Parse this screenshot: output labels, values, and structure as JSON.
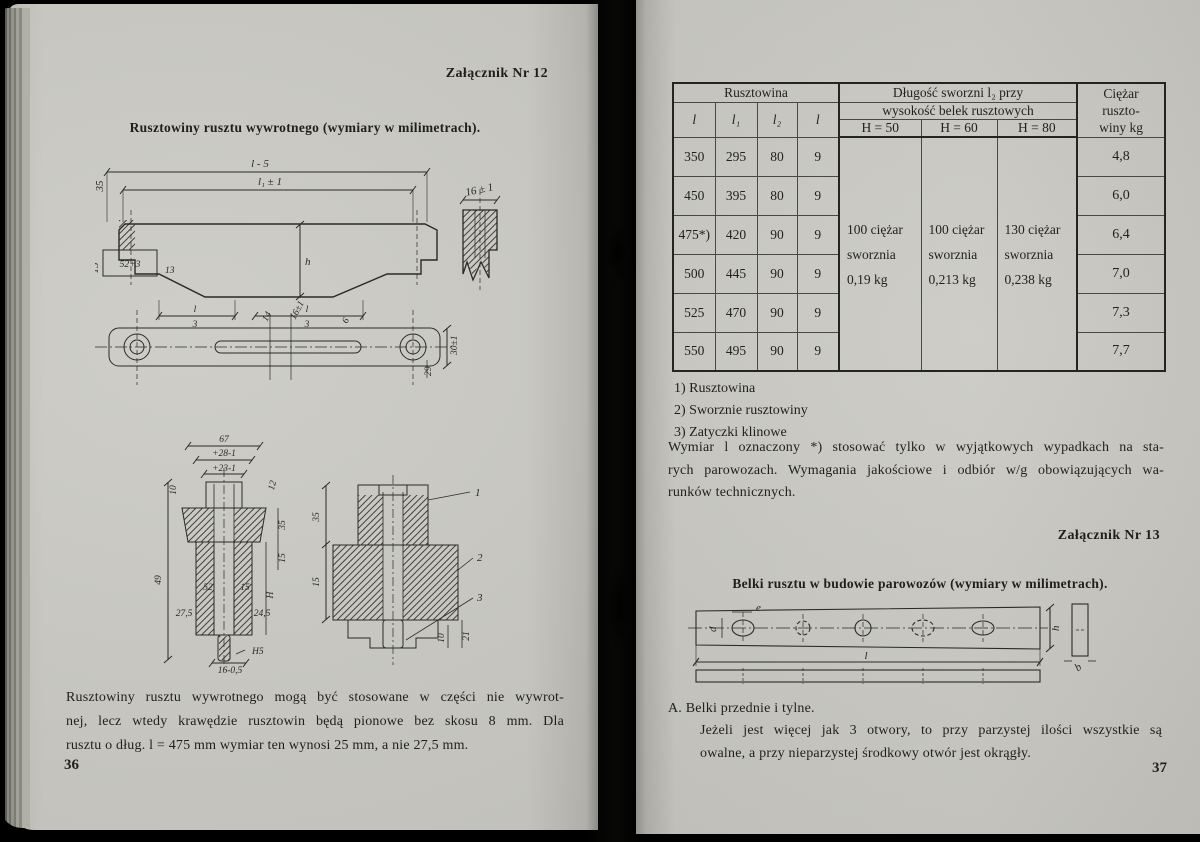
{
  "colors": {
    "paper": "#c8c7c1",
    "ink": "#201f1b",
    "table_line": "#26241f"
  },
  "left_page": {
    "annex_label": "Załącznik Nr 12",
    "title": "Rusztowiny rusztu wywrotnego (wymiary w milimetrach).",
    "page_number": "36",
    "paragraph_lines": [
      "Rusztowiny rusztu wywrotnego mogą być stosowane w części nie wywrot-",
      "nej, lecz wtedy krawędzie rusztowin będą pionowe bez skosu 8 mm. Dla",
      "rusztu o dług. l = 475 mm wymiar ten wynosi 25 mm, a nie 27,5 mm."
    ],
    "fig1": {
      "l5": "l - 5",
      "l1": "l₁ ± 1",
      "d35": "35",
      "d15": "15",
      "box52": "52+3",
      "d13": "13",
      "h": "h",
      "frac_top": "l",
      "frac_bot": "3",
      "prof16": "16 ± 1"
    },
    "fig2": {
      "d14": "14",
      "d16": "16±1",
      "d6": "6",
      "d29": "29",
      "d30": "30±1"
    },
    "fig3": {
      "d67": "67",
      "d28": "+28-1",
      "d23": "+23-1",
      "d10": "10",
      "d12": "12",
      "d35": "35",
      "d15a": "15",
      "d49": "49",
      "d52": "52",
      "d15b": "15",
      "d275": "27,5",
      "d245": "24,5",
      "dH": "H",
      "dH5": "H5",
      "d16": "16-0,5"
    },
    "fig4": {
      "c1": "1",
      "c2": "2",
      "c3": "3",
      "d35": "35",
      "d15": "15",
      "d10": "10",
      "d21": "21"
    }
  },
  "right_page": {
    "page_number": "37",
    "table": {
      "group_rusztowina": "Rusztowina",
      "group_dlugosc": "Długość sworzni l₂ przy",
      "group_wysokosc": "wysokość belek rusztowych",
      "col_l": "l",
      "col_l1": "l₁",
      "col_l2": "l₂",
      "col_l_last": "l",
      "col_h50": "H = 50",
      "col_h60": "H = 60",
      "col_h80": "H = 80",
      "ciezar_lines": [
        "Ciężar",
        "ruszto-",
        "winy kg"
      ],
      "rows": [
        {
          "l": "350",
          "l1": "295",
          "l2": "80",
          "t": "9",
          "kg": "4,8"
        },
        {
          "l": "450",
          "l1": "395",
          "l2": "80",
          "t": "9",
          "kg": "6,0"
        },
        {
          "l": "475*)",
          "l1": "420",
          "l2": "90",
          "t": "9",
          "kg": "6,4"
        },
        {
          "l": "500",
          "l1": "445",
          "l2": "90",
          "t": "9",
          "kg": "7,0"
        },
        {
          "l": "525",
          "l1": "470",
          "l2": "90",
          "t": "9",
          "kg": "7,3"
        },
        {
          "l": "550",
          "l1": "495",
          "l2": "90",
          "t": "9",
          "kg": "7,7"
        }
      ],
      "bolt_h50": [
        "100 ciężar",
        "sworznia",
        "0,19  kg"
      ],
      "bolt_h60": [
        "100 ciężar",
        "sworznia",
        "0,213 kg"
      ],
      "bolt_h80": [
        "130 ciężar",
        "sworznia",
        "0,238 kg"
      ]
    },
    "footnotes": [
      "1)  Rusztowina",
      "2)  Sworznie rusztowiny",
      "3)  Zatyczki klinowe"
    ],
    "note_lines": [
      "Wymiar l oznaczony *) stosować tylko w wyjątkowych wypadkach na sta-",
      "rych parowozach. Wymagania jakościowe i odbiór w/g obowiązujących wa-",
      "runków technicznych."
    ],
    "annex_label_13": "Załącznik Nr 13",
    "title_13": "Belki rusztu w budowie parowozów (wymiary w milimetrach).",
    "beam": {
      "d": "d",
      "e": "e",
      "l": "l",
      "h": "h",
      "b": "b"
    },
    "section_a_heading": "A.  Belki przednie i tylne.",
    "section_a_lines": [
      "Jeżeli jest więcej jak 3 otwory, to przy parzystej ilości wszystkie są",
      "owalne, a przy nieparzystej środkowy otwór jest okrągły."
    ]
  }
}
